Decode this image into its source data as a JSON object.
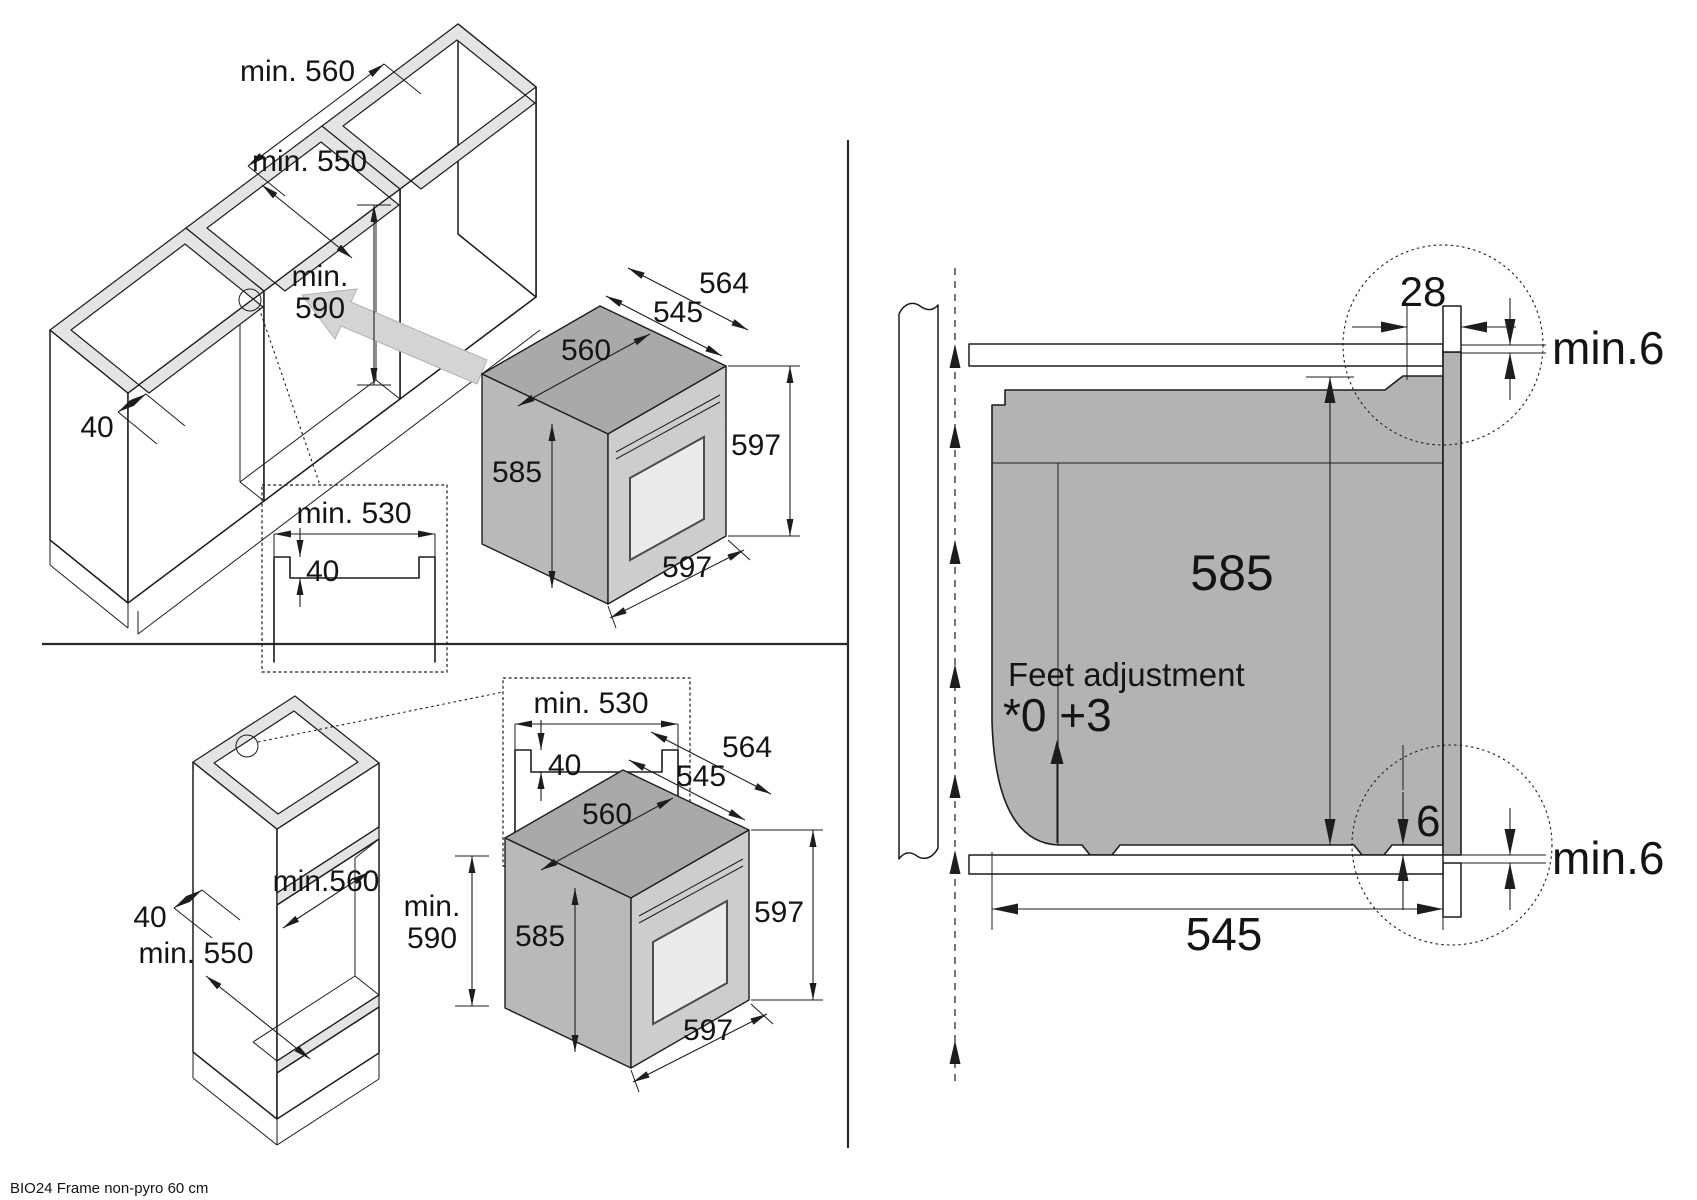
{
  "footer": {
    "note": "BIO24 Frame non-pyro 60 cm"
  },
  "base_panel": {
    "cab_width": "min. 560",
    "cab_depth": "min. 550",
    "niche_height_line1": "min.",
    "niche_height_line2": "590",
    "front_rail": "40",
    "inset": {
      "width": "min. 530",
      "depth": "40"
    },
    "oven": {
      "depth_total": "564",
      "depth_body": "545",
      "width_top": "560",
      "height_side": "585",
      "height_front": "597",
      "width_front": "597"
    }
  },
  "tall_panel": {
    "niche_height_line1": "min.",
    "niche_height_line2": "590",
    "niche_width": "min.560",
    "front_rail": "40",
    "cab_depth": "min. 550",
    "inset": {
      "width": "min. 530",
      "depth": "40"
    },
    "oven": {
      "depth_total": "564",
      "depth_body": "545",
      "width_top": "560",
      "height_side": "585",
      "height_front": "597",
      "width_front": "597"
    }
  },
  "section_panel": {
    "trim_width": "28",
    "gap_top": "min.6",
    "body_height": "585",
    "feet_label": "Feet adjustment",
    "feet_range": "*0 +3",
    "bottom_clearance": "6",
    "gap_bottom": "min.6",
    "body_depth": "545"
  }
}
